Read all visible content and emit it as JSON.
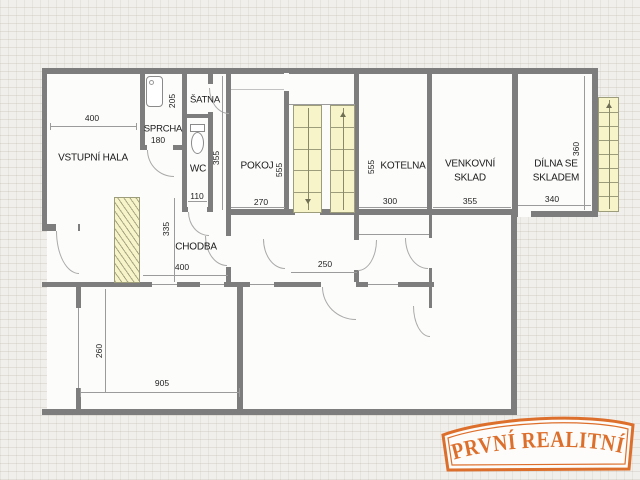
{
  "logo": {
    "brand": "PRVNÍ REALITNÍ"
  },
  "rooms": {
    "vstupni_hala": {
      "name": "VSTUPNÍ HALA",
      "width": "400"
    },
    "sprcha": {
      "name": "SPRCHA",
      "width": "180",
      "depth": "205"
    },
    "satna": {
      "name": "ŠATNA",
      "depth": "355"
    },
    "wc": {
      "name": "WC",
      "width": "110"
    },
    "pokoj": {
      "name": "POKOJ",
      "width": "270",
      "depth": "555"
    },
    "kotelna": {
      "name": "KOTELNA",
      "width": "300",
      "depth": "555"
    },
    "venkovni_sklad": {
      "name_line1": "VENKOVNÍ",
      "name_line2": "SKLAD",
      "width": "355"
    },
    "dilna_se_skladem": {
      "name_line1": "DÍLNA SE",
      "name_line2": "SKLADEM",
      "width": "340",
      "depth": "360"
    },
    "chodba": {
      "name": "CHODBA",
      "width": "400",
      "depth": "335"
    },
    "stair_hall": {
      "width": "250"
    },
    "bottom_room": {
      "width": "905",
      "depth": "260"
    }
  },
  "colors": {
    "wall": "#7d7d7d",
    "stairs_fill": "#f7f4ca",
    "logo_orange": "#dd6f2c"
  }
}
